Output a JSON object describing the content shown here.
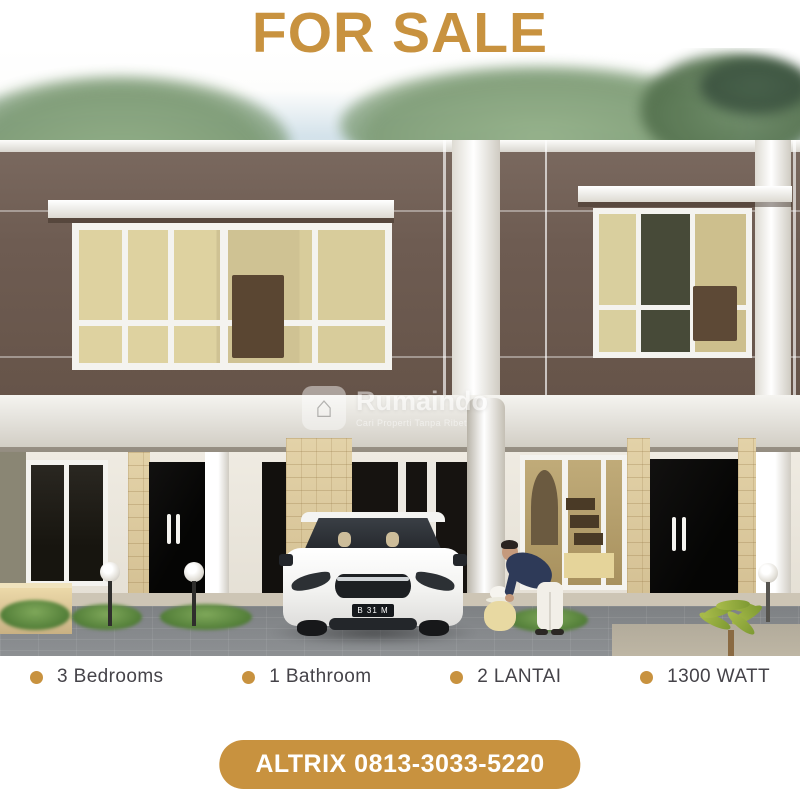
{
  "title": "FOR SALE",
  "accent_color": "#C8923F",
  "text_color": "#454349",
  "watermark": {
    "brand": "Rumaindo",
    "tagline": "Cari Properti Tanpa Ribet",
    "logo_icon": "house-icon",
    "logo_glyph": "⌂"
  },
  "scene": {
    "car_plate": "B 31 M"
  },
  "features": [
    {
      "label": "3 Bedrooms"
    },
    {
      "label": "1 Bathroom"
    },
    {
      "label": "2 LANTAI"
    },
    {
      "label": "1300 WATT"
    }
  ],
  "cta": {
    "label": "ALTRIX 0813-3033-5220"
  }
}
